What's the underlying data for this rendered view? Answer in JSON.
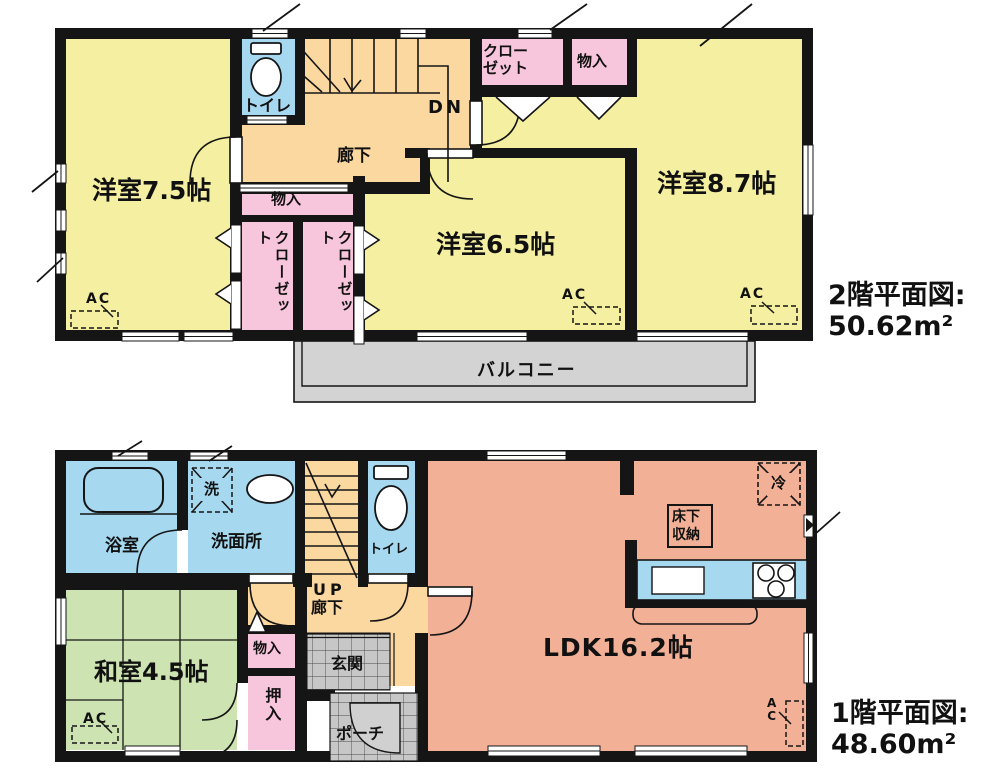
{
  "palette": {
    "room_yellow": "#f5efa1",
    "corridor_orange": "#fbd8a0",
    "closet_pink": "#f8c6dc",
    "water_blue": "#a6d8ef",
    "ldk_salmon": "#f2b096",
    "tatami_green": "#cde4b2",
    "tile_gray": "#c7c7c7",
    "balcony_gray": "#d3d3d3",
    "wall_black": "#151515"
  },
  "floor2": {
    "title": "2階平面図:",
    "area": "50.62m²",
    "rooms": {
      "west75": "洋室7.5帖",
      "west65": "洋室6.5帖",
      "west87": "洋室8.7帖",
      "toilet": "トイレ",
      "hallway": "廊下",
      "stairs_dn": "DN",
      "closet_top_l1": "クロー",
      "closet_top_l2": "ゼット",
      "storage_top": "物入",
      "storage_mid": "物入",
      "closet_v_left": "クローゼット",
      "closet_v_right": "クローゼット",
      "balcony": "バルコニー",
      "ac": "AC"
    }
  },
  "floor1": {
    "title": "1階平面図:",
    "area": "48.60m²",
    "rooms": {
      "bath": "浴室",
      "laundry": "洗",
      "washroom": "洗面所",
      "toilet": "トイレ",
      "stairs_up": "UP",
      "hallway": "廊下",
      "storage": "物入",
      "oshiire": "押入",
      "entrance": "玄関",
      "porch": "ポーチ",
      "japanese_room": "和室4.5帖",
      "ldk": "LDK16.2帖",
      "underfloor_l1": "床下",
      "underfloor_l2": "収納",
      "fridge": "冷",
      "ac": "AC",
      "ac_v_l1": "A",
      "ac_v_l2": "C"
    }
  }
}
